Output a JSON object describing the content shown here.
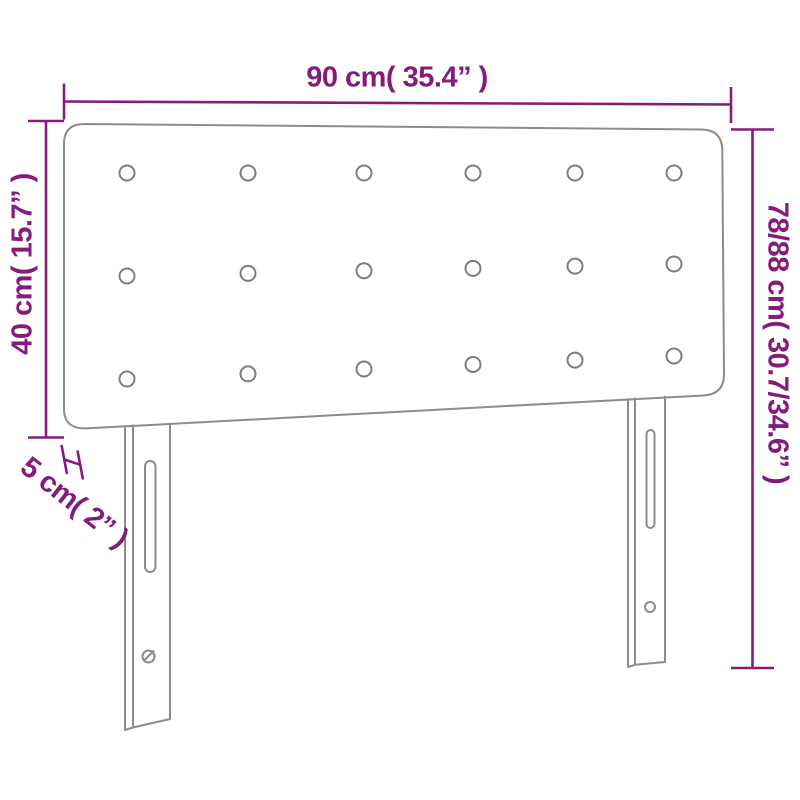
{
  "diagram": {
    "type": "furniture-dimension-diagram",
    "subject": "tufted headboard with two mounting legs, front view",
    "labels": {
      "width": "90 cm( 35.4” )",
      "panel_height": "40 cm( 15.7” )",
      "total_height": "78/88 cm( 30.7/34.6” )",
      "thickness": "5 cm( 2” )"
    },
    "tufting_buttons": {
      "rows": 3,
      "columns": 6,
      "count": 18
    },
    "legs": 2,
    "colors": {
      "dimension_accent": "#841c7b",
      "drawing_outline": "#8c8c8c",
      "background": "#ffffff"
    }
  }
}
